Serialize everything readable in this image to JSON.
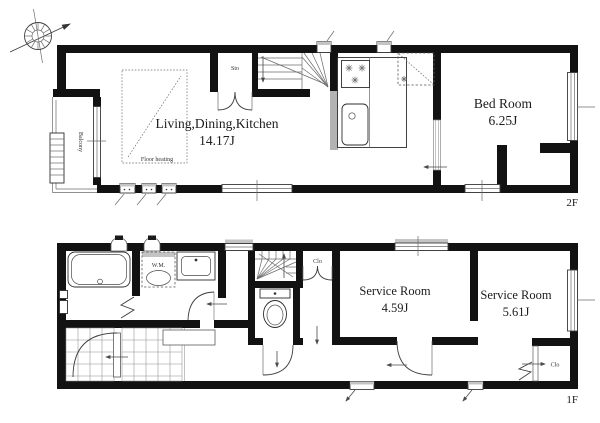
{
  "floor_2f": {
    "label": "2F",
    "ldk": {
      "name": "Living,Dining,Kitchen",
      "area": "14.17J"
    },
    "bedroom": {
      "name": "Bed Room",
      "area": "6.25J"
    },
    "floor_heating": "Floor heating",
    "balcony": "Balcony",
    "storage": "Sto"
  },
  "floor_1f": {
    "label": "1F",
    "service_room_a": {
      "name": "Service Room",
      "area": "4.59J"
    },
    "service_room_b": {
      "name": "Service Room",
      "area": "5.61J"
    },
    "washing_machine": "W.M.",
    "closet_hall": "Clo",
    "closet_corner": "Clo"
  },
  "colors": {
    "wall": "#121212",
    "line": "#3d3d3d",
    "window_sill": "#c4c4c4",
    "background": "#ffffff"
  }
}
